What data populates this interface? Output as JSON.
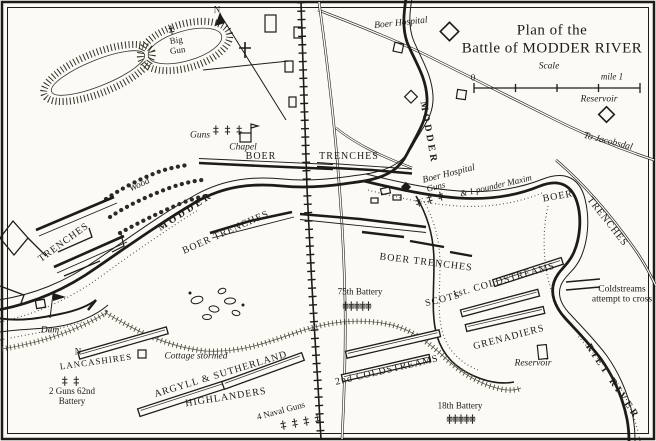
{
  "title": {
    "line1": "Plan of the",
    "line2": "Battle of MODDER RIVER"
  },
  "scale": {
    "label": "Scale",
    "zero": "0",
    "mile": "mile 1"
  },
  "compass": {
    "north": "N"
  },
  "rivers": {
    "modder_west": "MODDER",
    "modder_north": "MODDER",
    "riet": "RIET RIVER"
  },
  "places": {
    "boer_hospital_top": "Boer Hospital",
    "reservoir_top": "Reservoir",
    "to_jacobsdal": "To Jacobsdal",
    "big_gun": "Big Gun",
    "chapel": "Chapel",
    "wood": "Wood",
    "dam": "Dam",
    "cottage": "Cottage stormed",
    "reservoir_bottom": "Reservoir",
    "n_marker": "N"
  },
  "boer": {
    "guns_chapel": "Guns",
    "boer_label_west": "BOER",
    "trenches_label_east": "TRENCHES",
    "boer_trenches_sw": "BOER TRENCHES",
    "boer_trenches_mid": "BOER TRENCHES",
    "trenches_left": "TRENCHES",
    "boer_hospital": "Boer Hospital",
    "guns_hospital": "Guns",
    "maxim": "& 1 pounder Maxim",
    "boer_right": "BOER",
    "trenches_right": "TRENCHES"
  },
  "british": {
    "lancashires": "LANCASHIRES",
    "argyll": "ARGYLL & SUTHERLAND",
    "highlanders": "HIGHLANDERS",
    "two_guns": "2 Guns 62nd Battery",
    "naval_guns": "4 Naval Guns",
    "battery_75": "75th Battery",
    "battery_18": "18th Battery",
    "coldstreams_2nd": "2nd COLDSTREAMS",
    "coldstreams_1st": "1st. COLDSTREAMS",
    "scots": "SCOTS",
    "grenadiers": "GRENADIERS",
    "coldstreams_attempt": "Coldstreams attempt to cross"
  },
  "icons": {
    "gun_single": "‡",
    "guns_two": "‡ ‡",
    "guns_three": "‡ ‡ ‡",
    "guns_four": "‡ ‡ ‡ ‡",
    "guns_five": "‡‡‡‡‡"
  },
  "colors": {
    "ink": "#1d1c18",
    "paper": "#fbfaf5"
  }
}
